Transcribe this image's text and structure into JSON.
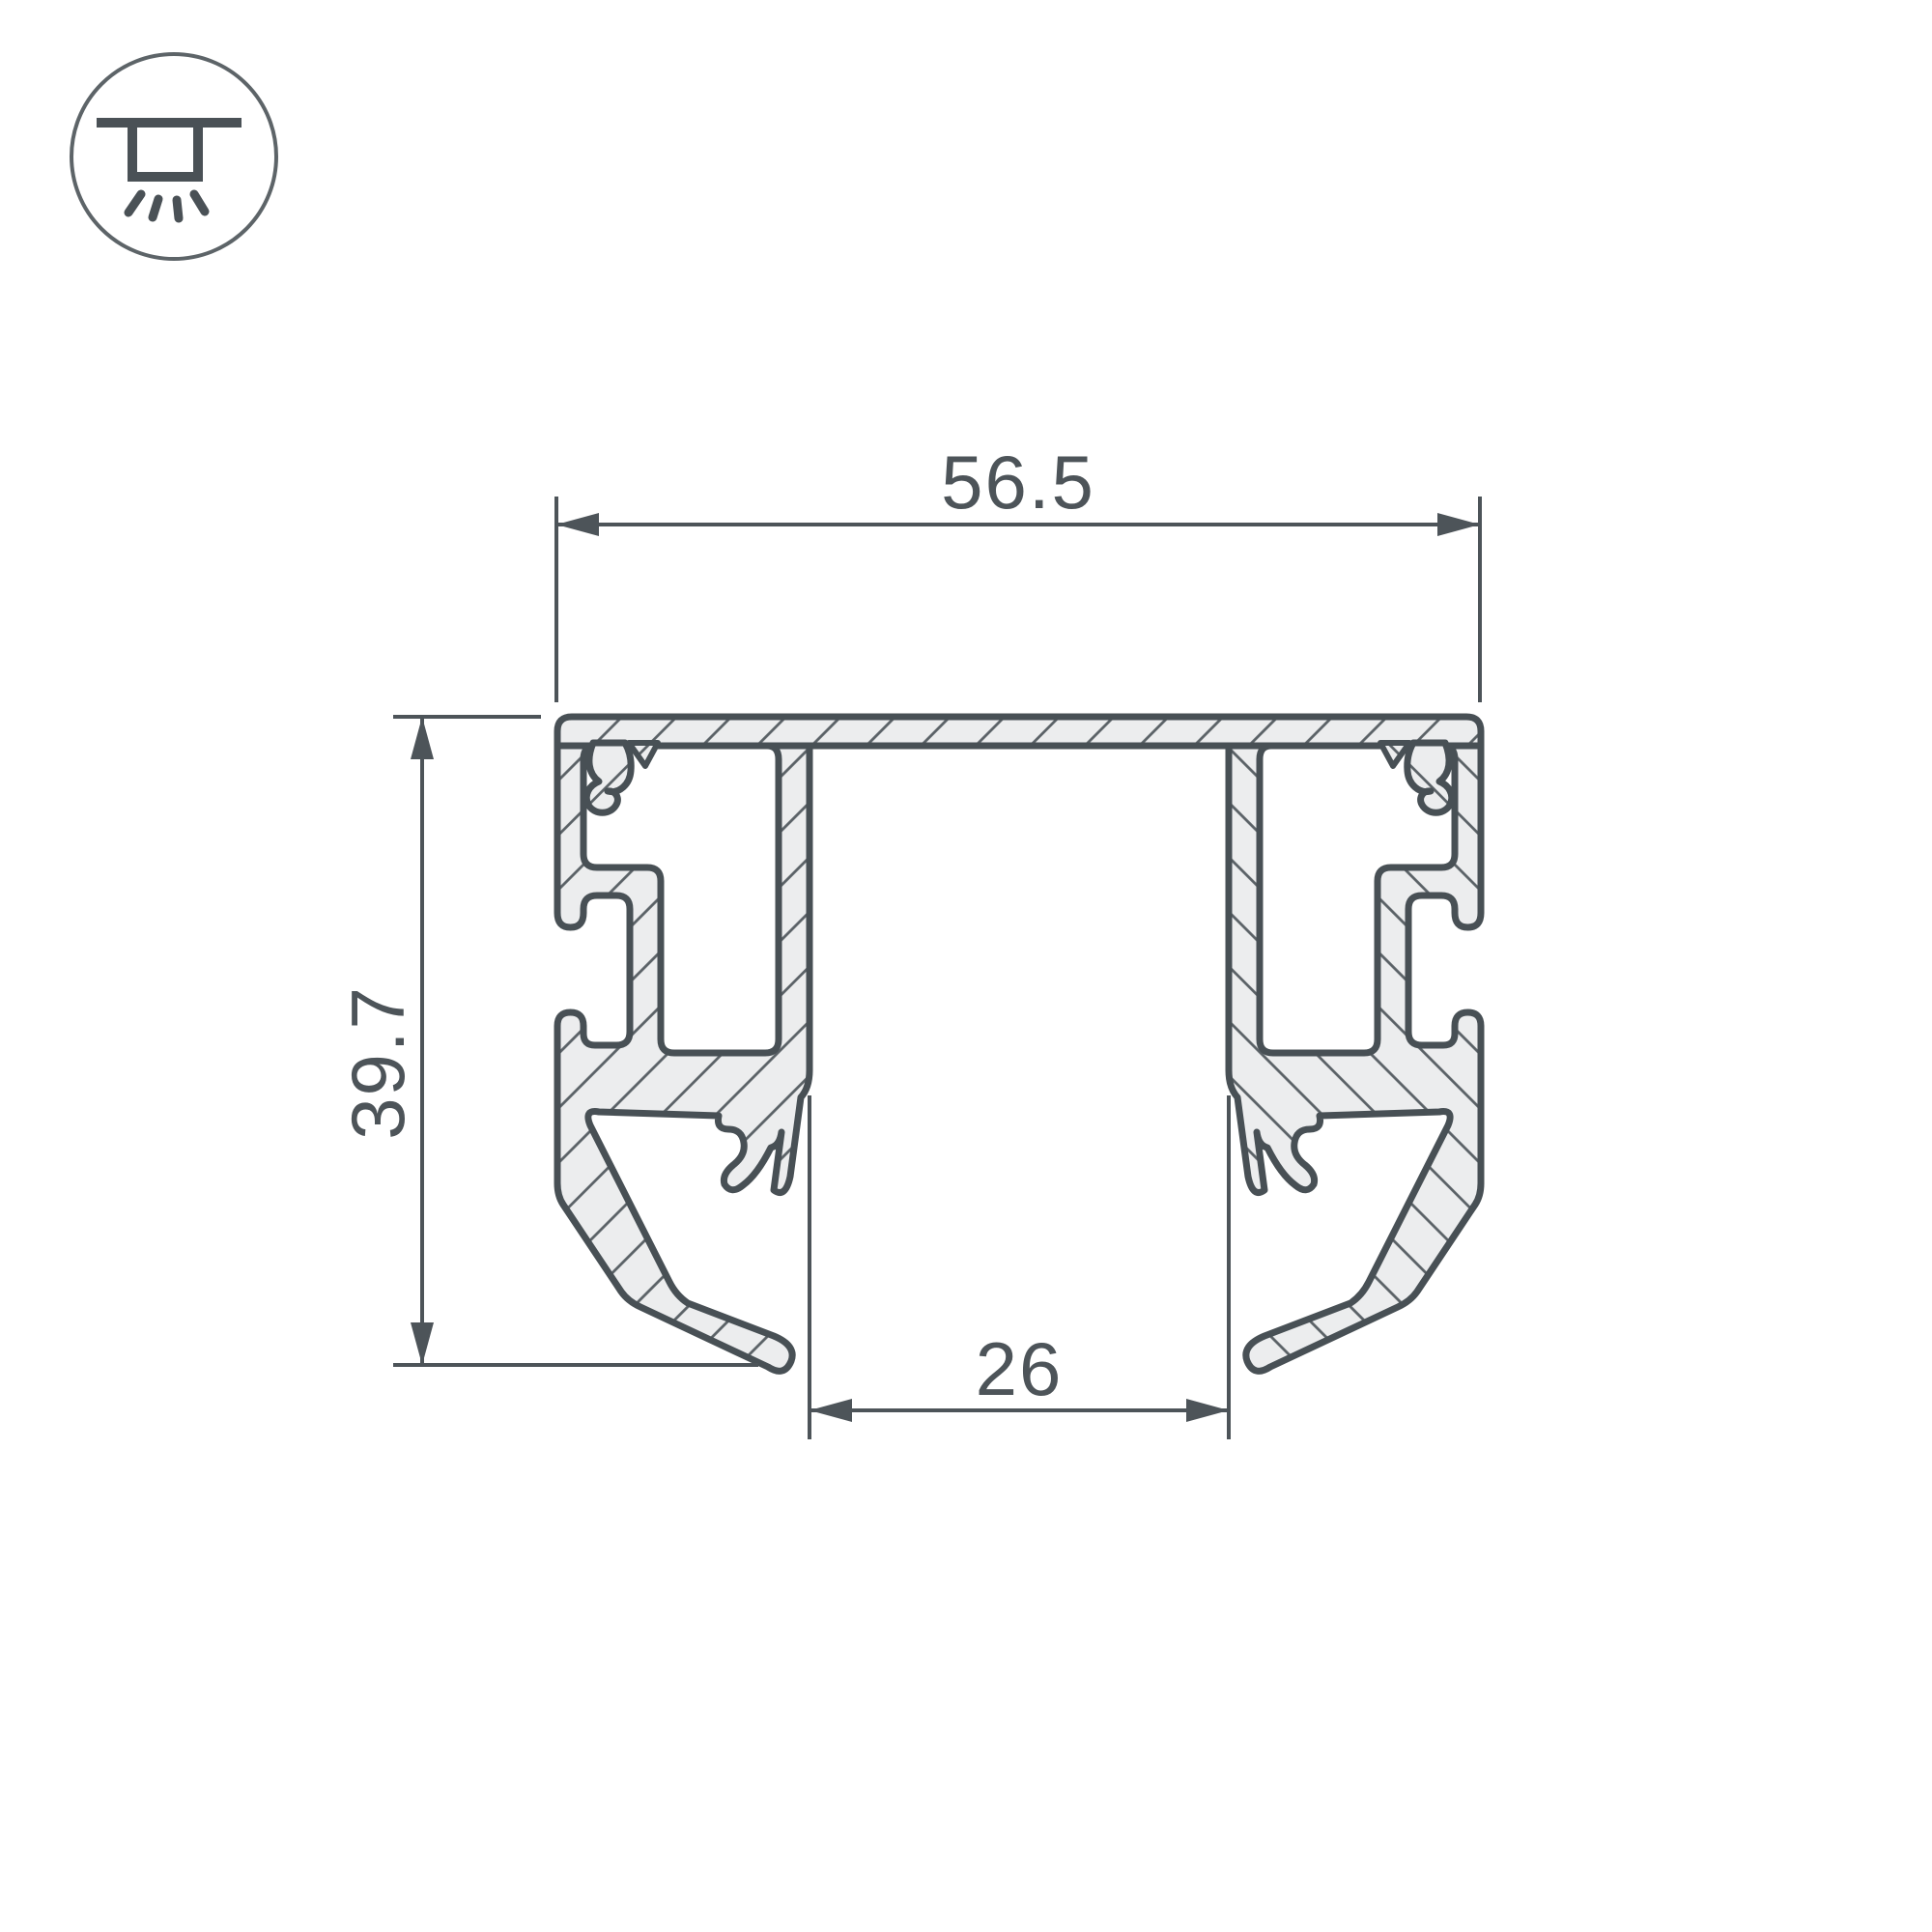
{
  "drawing": {
    "type": "technical-cross-section",
    "subject": "aluminium LED profile cross-section",
    "background": "#ffffff",
    "colors": {
      "outline": "#485055",
      "material_fill": "#ecedee",
      "hatch_line": "#5a6166",
      "dimension_line": "#4d5459",
      "icon_stroke": "#4a5156",
      "icon_circle": "#5d6468"
    },
    "icon": {
      "name": "ceiling-recessed-light-icon",
      "description": "circle badge with ceiling line, hanging fixture box and four light rays"
    },
    "dimensions": {
      "overall_width": {
        "value": "56.5",
        "orientation": "horizontal",
        "position": "top"
      },
      "overall_height": {
        "value": "39.7",
        "orientation": "vertical",
        "position": "left"
      },
      "channel_width": {
        "value": "26",
        "orientation": "horizontal",
        "position": "bottom-center"
      }
    },
    "hatching": {
      "angle_deg": 45,
      "spacing_px": 40
    }
  }
}
